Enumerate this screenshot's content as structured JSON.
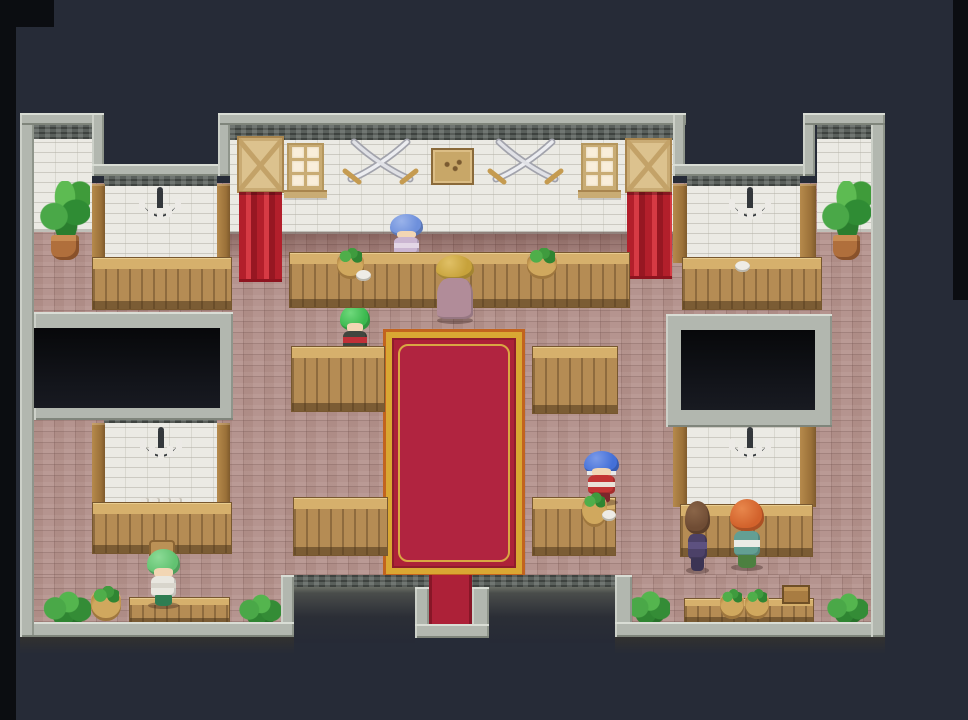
{
  "meta": {
    "domain": "game-screenshot",
    "description": "Top-down pixel-art RPG interior: a stone guild hall / tavern with white brick walls, mauve brick floor, wooden counters and tables, a red and gold carpet leading to the south exit, wall chandeliers, crossed-sword decorations, curtained doorways and seven NPC characters.",
    "canvas": {
      "w": 968,
      "h": 720
    }
  },
  "palette": {
    "background": "#262b37",
    "letterbox": "#0b0d11",
    "wall_border": "#b2b7af",
    "wall_cap": "#5a605c",
    "white_brick": "#ebeae4",
    "floor_brick": "#b5948f",
    "wood": "#b58c54",
    "wood_light": "#d6b06c",
    "carpet_red": "#ad2138",
    "carpet_gold": "#d9a733",
    "curtain_red": "#c02b33",
    "plant_green": "#3f9b3a",
    "pot_terracotta": "#b06f3c",
    "chandelier_iron": "#33373b",
    "candle_white": "#eceae6"
  },
  "scene": {
    "elements": [
      {
        "t": "strip",
        "n": "letterbox-left",
        "x": 0,
        "y": 0,
        "w": 16,
        "h": 720
      },
      {
        "t": "strip",
        "n": "letterbox-top-left",
        "x": 0,
        "y": 0,
        "w": 54,
        "h": 27
      },
      {
        "t": "strip",
        "n": "letterbox-right",
        "x": 953,
        "y": 0,
        "w": 15,
        "h": 300
      },
      {
        "t": "floor",
        "n": "floor-main",
        "x": 33,
        "y": 183,
        "w": 838,
        "h": 392
      },
      {
        "t": "floor",
        "n": "floor-bottom-left",
        "x": 33,
        "y": 575,
        "w": 248,
        "h": 47
      },
      {
        "t": "floor",
        "n": "floor-bottom-right",
        "x": 632,
        "y": 575,
        "w": 239,
        "h": 47
      },
      {
        "t": "brickwall",
        "n": "wall-tower-left",
        "x": 34,
        "y": 137,
        "w": 58,
        "h": 95
      },
      {
        "t": "brickwall",
        "n": "wall-tower-right",
        "x": 817,
        "y": 137,
        "w": 54,
        "h": 95
      },
      {
        "t": "brickwall",
        "n": "wall-top-main",
        "x": 230,
        "y": 137,
        "w": 443,
        "h": 97
      },
      {
        "t": "shade",
        "n": "wall-shadow-band",
        "x": 230,
        "y": 232,
        "w": 443,
        "h": 26
      },
      {
        "t": "brickwall",
        "n": "wall-alcove-upper-left",
        "x": 104,
        "y": 184,
        "w": 113,
        "h": 79
      },
      {
        "t": "brickwall",
        "n": "wall-alcove-upper-right",
        "x": 687,
        "y": 184,
        "w": 113,
        "h": 79
      },
      {
        "t": "brickwall",
        "n": "wall-alcove-lower-left",
        "x": 104,
        "y": 421,
        "w": 113,
        "h": 86
      },
      {
        "t": "brickwall",
        "n": "wall-alcove-lower-right",
        "x": 687,
        "y": 421,
        "w": 113,
        "h": 86
      },
      {
        "t": "cap",
        "n": "cap-tower-left",
        "x": 34,
        "y": 124,
        "w": 58,
        "h": 15
      },
      {
        "t": "cap",
        "n": "cap-top-main",
        "x": 230,
        "y": 124,
        "w": 443,
        "h": 16
      },
      {
        "t": "cap",
        "n": "cap-tower-right",
        "x": 817,
        "y": 124,
        "w": 54,
        "h": 15
      },
      {
        "t": "cap",
        "n": "cap-alcove-upper-left",
        "x": 104,
        "y": 176,
        "w": 113,
        "h": 10
      },
      {
        "t": "cap",
        "n": "cap-alcove-upper-right",
        "x": 687,
        "y": 176,
        "w": 113,
        "h": 10
      },
      {
        "t": "cap",
        "n": "cap-alcove-lower-left",
        "x": 104,
        "y": 413,
        "w": 113,
        "h": 10
      },
      {
        "t": "cap",
        "n": "cap-alcove-lower-right",
        "x": 687,
        "y": 413,
        "w": 113,
        "h": 10
      },
      {
        "t": "pillar",
        "n": "pillar-ul-1",
        "x": 92,
        "y": 184,
        "w": 13,
        "h": 79
      },
      {
        "t": "pillar",
        "n": "pillar-ul-2",
        "x": 217,
        "y": 184,
        "w": 13,
        "h": 79
      },
      {
        "t": "pillar",
        "n": "pillar-ur-1",
        "x": 673,
        "y": 184,
        "w": 14,
        "h": 79
      },
      {
        "t": "pillar",
        "n": "pillar-ur-2",
        "x": 800,
        "y": 184,
        "w": 16,
        "h": 79
      },
      {
        "t": "pillar",
        "n": "pillar-ll-1",
        "x": 92,
        "y": 423,
        "w": 13,
        "h": 84
      },
      {
        "t": "pillar",
        "n": "pillar-ll-2",
        "x": 217,
        "y": 423,
        "w": 13,
        "h": 84
      },
      {
        "t": "pillar",
        "n": "pillar-lr-1",
        "x": 673,
        "y": 423,
        "w": 14,
        "h": 84
      },
      {
        "t": "pillar",
        "n": "pillar-lr-2",
        "x": 800,
        "y": 423,
        "w": 16,
        "h": 84
      },
      {
        "t": "boxframe",
        "n": "opening-frame-left",
        "x": 34,
        "y": 312,
        "w": 199,
        "h": 108
      },
      {
        "t": "boxdark",
        "n": "dark-opening-left",
        "x": 34,
        "y": 328,
        "w": 186,
        "h": 80
      },
      {
        "t": "boxframe",
        "n": "opening-frame-right",
        "x": 666,
        "y": 314,
        "w": 166,
        "h": 113
      },
      {
        "t": "boxdark",
        "n": "dark-opening-right",
        "x": 681,
        "y": 330,
        "w": 134,
        "h": 80
      },
      {
        "t": "door",
        "n": "door-panel-left",
        "x": 237,
        "y": 136,
        "w": 47,
        "h": 57,
        "act": true
      },
      {
        "t": "door",
        "n": "door-panel-right",
        "x": 625,
        "y": 138,
        "w": 47,
        "h": 55,
        "act": true
      },
      {
        "t": "curtain",
        "n": "curtain-left",
        "x": 239,
        "y": 192,
        "w": 43,
        "h": 90
      },
      {
        "t": "curtain",
        "n": "curtain-right",
        "x": 627,
        "y": 192,
        "w": 45,
        "h": 87
      },
      {
        "t": "window",
        "n": "window-left",
        "x": 287,
        "y": 143,
        "w": 37,
        "h": 55
      },
      {
        "t": "window",
        "n": "window-right",
        "x": 581,
        "y": 143,
        "w": 37,
        "h": 55
      },
      {
        "t": "swords",
        "n": "crossed-swords-left-icon",
        "x": 341,
        "y": 137,
        "w": 79,
        "h": 49
      },
      {
        "t": "swords",
        "n": "crossed-swords-right-icon",
        "x": 486,
        "y": 137,
        "w": 79,
        "h": 49
      },
      {
        "t": "plaque",
        "n": "wall-plaque",
        "x": 431,
        "y": 148,
        "w": 43,
        "h": 37
      },
      {
        "t": "chandelier",
        "n": "chandelier-upper-left-icon",
        "x": 136,
        "y": 186,
        "w": 48,
        "h": 50
      },
      {
        "t": "chandelier",
        "n": "chandelier-upper-right-icon",
        "x": 726,
        "y": 186,
        "w": 48,
        "h": 50
      },
      {
        "t": "chandelier",
        "n": "chandelier-lower-left-icon",
        "x": 137,
        "y": 426,
        "w": 48,
        "h": 50
      },
      {
        "t": "chandelier",
        "n": "chandelier-lower-right-icon",
        "x": 726,
        "y": 426,
        "w": 48,
        "h": 50
      },
      {
        "t": "mugs",
        "n": "mug-shelf",
        "x": 141,
        "y": 496,
        "w": 44,
        "h": 14
      },
      {
        "t": "carpet",
        "n": "red-carpet",
        "x": 383,
        "y": 329,
        "w": 142,
        "h": 248
      },
      {
        "t": "char",
        "n": "npc-shopkeeper-blue",
        "x": 389,
        "y": 214,
        "w": 35,
        "h": 50,
        "act": true,
        "colors": {
          "hair": "#6e90dc",
          "hairLight": "#9ab3ea",
          "face": "#f2d6b4",
          "body": "#cbb6d2",
          "accent": "#e3d6e6",
          "legs": "#9c8bba"
        }
      },
      {
        "t": "char",
        "n": "npc-kid-green-hair",
        "x": 339,
        "y": 305,
        "w": 32,
        "h": 56,
        "act": true,
        "colors": {
          "hair": "#3bb84e",
          "hairLight": "#6fd97c",
          "face": "#f2d6b4",
          "body": "#41463f",
          "accent": "#c03038",
          "legs": "#356e3c"
        }
      },
      {
        "t": "counter",
        "n": "counter-main",
        "x": 289,
        "y": 252,
        "w": 341,
        "h": 56
      },
      {
        "t": "counter",
        "n": "counter-upper-left",
        "x": 92,
        "y": 257,
        "w": 140,
        "h": 53
      },
      {
        "t": "counter",
        "n": "counter-upper-right",
        "x": 682,
        "y": 257,
        "w": 140,
        "h": 53
      },
      {
        "t": "counter",
        "n": "counter-lower-left",
        "x": 92,
        "y": 502,
        "w": 140,
        "h": 52
      },
      {
        "t": "counter",
        "n": "counter-lower-right",
        "x": 680,
        "y": 504,
        "w": 133,
        "h": 53
      },
      {
        "t": "table",
        "n": "table-mid-left-upper",
        "x": 291,
        "y": 346,
        "w": 94,
        "h": 66
      },
      {
        "t": "table",
        "n": "table-mid-right-upper",
        "x": 532,
        "y": 346,
        "w": 86,
        "h": 68
      },
      {
        "t": "table",
        "n": "table-mid-left-lower",
        "x": 293,
        "y": 497,
        "w": 95,
        "h": 59
      },
      {
        "t": "table",
        "n": "table-mid-right-lower",
        "x": 532,
        "y": 497,
        "w": 84,
        "h": 59
      },
      {
        "t": "chairback",
        "n": "chair-back",
        "x": 149,
        "y": 540,
        "w": 26,
        "h": 16
      },
      {
        "t": "bench",
        "n": "bench-bottom-left",
        "x": 129,
        "y": 597,
        "w": 101,
        "h": 27
      },
      {
        "t": "bench",
        "n": "bench-bottom-right",
        "x": 684,
        "y": 598,
        "w": 130,
        "h": 25
      },
      {
        "t": "char",
        "n": "npc-customer-blonde-robe",
        "x": 435,
        "y": 255,
        "w": 40,
        "h": 67,
        "v": "robe",
        "act": true,
        "colors": {
          "hair": "#c7a23b",
          "hairLight": "#e0c066",
          "body": "#b18c99"
        }
      },
      {
        "t": "char",
        "n": "npc-warrior-blue-hair",
        "x": 583,
        "y": 451,
        "w": 37,
        "h": 53,
        "act": true,
        "colors": {
          "hair": "#4470d8",
          "hairLight": "#7b9ae8",
          "band": "#e8e8e8",
          "face": "#f2d6b4",
          "body": "#c23434",
          "accent": "#e9e2d8",
          "legs": "#7c262c"
        }
      },
      {
        "t": "char",
        "n": "npc-villager-purple",
        "x": 684,
        "y": 501,
        "w": 27,
        "h": 71,
        "act": true,
        "colors": {
          "hair": "#6f4c34",
          "hairLight": "#8a6548",
          "body": "#4c4168",
          "accent": "#5d5180",
          "legs": "#3b3454"
        }
      },
      {
        "t": "char",
        "n": "npc-villager-orange-hair",
        "x": 729,
        "y": 499,
        "w": 36,
        "h": 70,
        "act": true,
        "colors": {
          "hair": "#d2622c",
          "hairLight": "#e8874c",
          "body": "#639f93",
          "accent": "#ebebe6",
          "legs": "#4c8040"
        }
      },
      {
        "t": "char",
        "n": "npc-kid-green-bandana",
        "x": 146,
        "y": 549,
        "w": 35,
        "h": 58,
        "act": true,
        "colors": {
          "hair": "#62c271",
          "hairLight": "#8cdb96",
          "face": "#f2d6b4",
          "body": "#e9e7e0",
          "accent": "#d8d5cc",
          "legs": "#2f7d52"
        }
      },
      {
        "t": "pottedplant",
        "n": "potted-plant-top-left",
        "x": 40,
        "y": 181,
        "w": 50,
        "h": 79
      },
      {
        "t": "pottedplant",
        "n": "potted-plant-top-right",
        "x": 822,
        "y": 181,
        "w": 49,
        "h": 79
      },
      {
        "t": "basket",
        "n": "veggie-basket-counter-1",
        "x": 337,
        "y": 252,
        "w": 27,
        "h": 27
      },
      {
        "t": "basket",
        "n": "veggie-basket-counter-2",
        "x": 527,
        "y": 252,
        "w": 30,
        "h": 27
      },
      {
        "t": "dish",
        "n": "dish-counter-1",
        "x": 356,
        "y": 270,
        "w": 15,
        "h": 11
      },
      {
        "t": "dish",
        "n": "dish-counter-2",
        "x": 735,
        "y": 261,
        "w": 15,
        "h": 11
      },
      {
        "t": "basket",
        "n": "veggie-basket-warrior",
        "x": 582,
        "y": 496,
        "w": 25,
        "h": 31
      },
      {
        "t": "dish",
        "n": "dish-warrior",
        "x": 602,
        "y": 510,
        "w": 14,
        "h": 11
      },
      {
        "t": "basket",
        "n": "basket-bottom-left",
        "x": 91,
        "y": 590,
        "w": 30,
        "h": 31
      },
      {
        "t": "bush",
        "n": "plant-bottom-left-1",
        "x": 41,
        "y": 588,
        "w": 50,
        "h": 37
      },
      {
        "t": "bush",
        "n": "plant-bottom-left-2",
        "x": 237,
        "y": 591,
        "w": 44,
        "h": 34
      },
      {
        "t": "bush",
        "n": "plant-bottom-right-1",
        "x": 626,
        "y": 587,
        "w": 44,
        "h": 37
      },
      {
        "t": "basket",
        "n": "veggie-basket-bench-1",
        "x": 720,
        "y": 593,
        "w": 24,
        "h": 26
      },
      {
        "t": "basket",
        "n": "veggie-basket-bench-2",
        "x": 745,
        "y": 593,
        "w": 24,
        "h": 26
      },
      {
        "t": "crate",
        "n": "wooden-crate",
        "x": 782,
        "y": 585,
        "w": 28,
        "h": 19
      },
      {
        "t": "bush",
        "n": "plant-bottom-right-2",
        "x": 825,
        "y": 590,
        "w": 43,
        "h": 33
      },
      {
        "t": "cap",
        "n": "cap-bottom-wall",
        "x": 281,
        "y": 575,
        "w": 351,
        "h": 12
      },
      {
        "t": "insetdark",
        "n": "bottom-inset-left",
        "x": 294,
        "y": 587,
        "w": 121,
        "h": 56
      },
      {
        "t": "insetdark",
        "n": "bottom-inset-right",
        "x": 489,
        "y": 587,
        "w": 126,
        "h": 56
      },
      {
        "t": "border",
        "n": "border-inset-left-wall",
        "x": 281,
        "y": 575,
        "w": 13,
        "h": 62
      },
      {
        "t": "border",
        "n": "border-exit-left-wall",
        "x": 415,
        "y": 587,
        "w": 14,
        "h": 40
      },
      {
        "t": "border",
        "n": "border-exit-right-wall",
        "x": 472,
        "y": 587,
        "w": 17,
        "h": 40
      },
      {
        "t": "border",
        "n": "border-exit-bottom",
        "x": 415,
        "y": 624,
        "w": 74,
        "h": 14
      },
      {
        "t": "border",
        "n": "border-inset-right-wall",
        "x": 615,
        "y": 575,
        "w": 17,
        "h": 62
      },
      {
        "t": "carpetstrip",
        "n": "carpet-exit-south",
        "x": 429,
        "y": 575,
        "w": 43,
        "h": 49,
        "act": true
      },
      {
        "t": "border",
        "n": "border-bottom-left",
        "x": 20,
        "y": 622,
        "w": 274,
        "h": 15
      },
      {
        "t": "border",
        "n": "border-bottom-right",
        "x": 615,
        "y": 622,
        "w": 270,
        "h": 15
      },
      {
        "t": "fade",
        "n": "wall-fade-bottom-left",
        "x": 20,
        "y": 637,
        "w": 274,
        "h": 17
      },
      {
        "t": "fade",
        "n": "wall-fade-bottom-right",
        "x": 615,
        "y": 637,
        "w": 270,
        "h": 17
      },
      {
        "t": "border",
        "n": "border-left-wall",
        "x": 20,
        "y": 113,
        "w": 14,
        "h": 524
      },
      {
        "t": "border",
        "n": "border-right-wall",
        "x": 871,
        "y": 113,
        "w": 14,
        "h": 524
      },
      {
        "t": "border",
        "n": "border-top-tower-left",
        "x": 20,
        "y": 113,
        "w": 84,
        "h": 12
      },
      {
        "t": "border",
        "n": "border-notch1-left",
        "x": 92,
        "y": 113,
        "w": 12,
        "h": 63
      },
      {
        "t": "border",
        "n": "border-notch1-bottom",
        "x": 92,
        "y": 164,
        "w": 138,
        "h": 12
      },
      {
        "t": "border",
        "n": "border-notch1-right",
        "x": 218,
        "y": 113,
        "w": 12,
        "h": 63
      },
      {
        "t": "border",
        "n": "border-top-main",
        "x": 218,
        "y": 113,
        "w": 468,
        "h": 12
      },
      {
        "t": "border",
        "n": "border-notch2-left",
        "x": 673,
        "y": 113,
        "w": 12,
        "h": 63
      },
      {
        "t": "border",
        "n": "border-notch2-bottom",
        "x": 673,
        "y": 164,
        "w": 142,
        "h": 12
      },
      {
        "t": "border",
        "n": "border-notch2-right",
        "x": 803,
        "y": 113,
        "w": 12,
        "h": 63
      },
      {
        "t": "border",
        "n": "border-top-tower-right",
        "x": 803,
        "y": 113,
        "w": 82,
        "h": 12
      }
    ]
  }
}
